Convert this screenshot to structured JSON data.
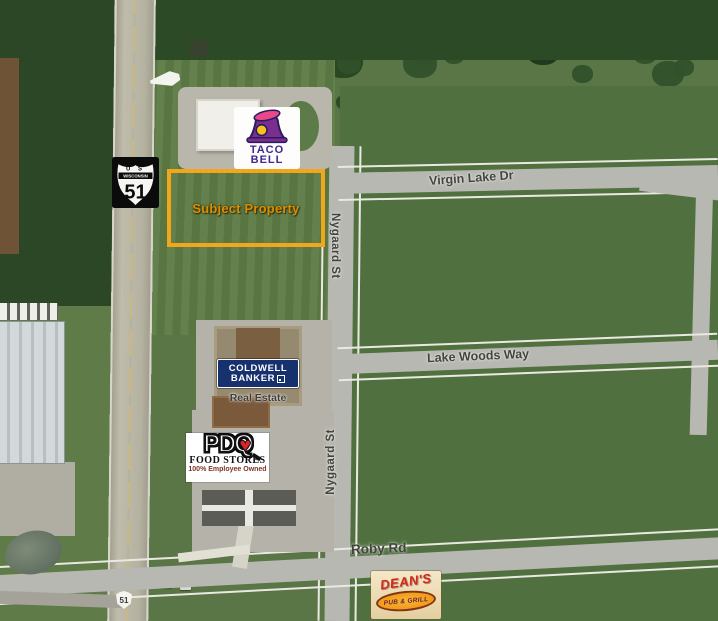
{
  "map": {
    "description": "Aerial site map with subject property outline at US Hwy 51 and Nygaard St"
  },
  "colors": {
    "accent": "#F2A71B",
    "accent-text": "#DB8E00",
    "cb-navy": "#17316F",
    "tb-purple": "#43298E",
    "pdq-red": "#D8252A",
    "deans-red": "#CF2A1B",
    "deans-orange": "#EF8E12"
  },
  "subject_property": {
    "label": "Subject Property"
  },
  "highway_shield": {
    "us": "U S",
    "state": "WISCONSIN",
    "route": "51"
  },
  "mini_shield": {
    "route": "51"
  },
  "streets": {
    "virgin_lake": "Virgin Lake Dr",
    "nygaard": "Nygaard St",
    "lake_woods": "Lake Woods Way",
    "roby": "Roby Rd"
  },
  "businesses": {
    "taco_bell": {
      "line1": "TACO",
      "line2": "BELL"
    },
    "coldwell_banker": {
      "line1": "COLDWELL",
      "line2": "BANKER",
      "subtitle": "Real Estate"
    },
    "pdq": {
      "brand": "PDQ",
      "line2": "FOOD STORES",
      "line3": "100% Employee Owned"
    },
    "deans": {
      "line1": "DEAN'S",
      "line2": "PUB & GRILL"
    }
  },
  "icons": {
    "pdq_heart": "♥"
  }
}
